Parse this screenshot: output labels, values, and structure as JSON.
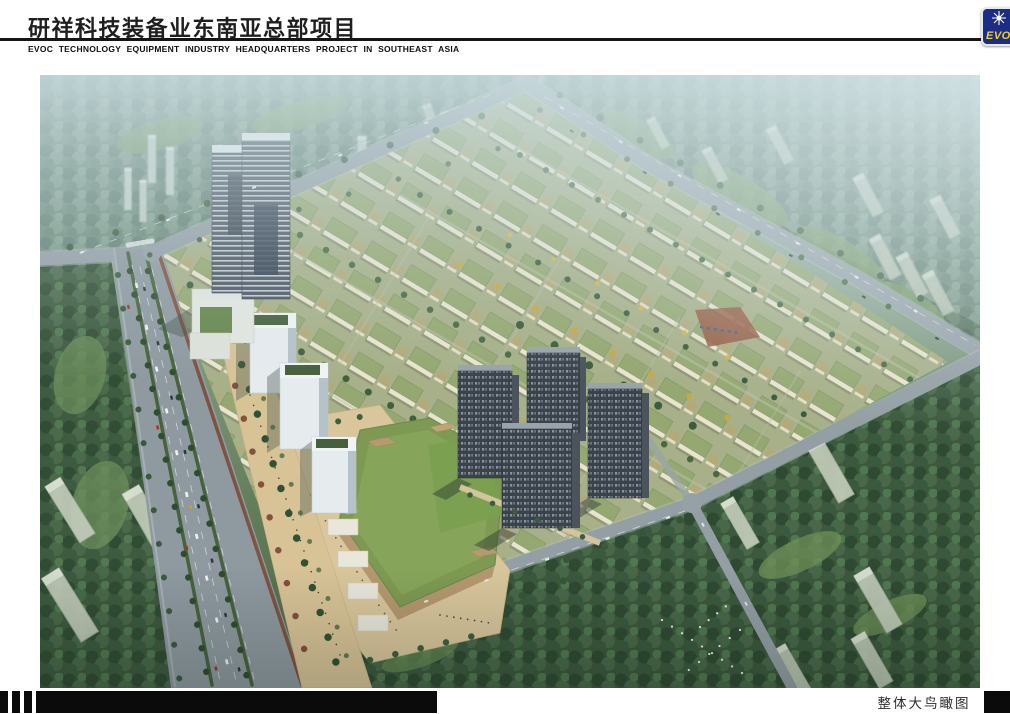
{
  "header": {
    "title": "研祥科技装备业东南亚总部项目",
    "subtitle": "EVOC TECHNOLOGY EQUIPMENT INDUSTRY HEADQUARTERS PROJECT IN SOUTHEAST ASIA",
    "logo": {
      "text": "EVOC",
      "icon": "starburst-icon",
      "bg_color": "#1c2d85",
      "text_color": "#f2cf25"
    }
  },
  "rendering": {
    "kind": "aerial bird's-eye architectural rendering",
    "scene_elements": [
      "twin high-rise office towers at north-west corner of site",
      "rows of small green-roofed industrial campus buildings",
      "four dark residential towers at site center-south",
      "large grass-roofed exhibition hall with beige pedestrian plaza",
      "tree-lined multi-lane boulevard along west edge",
      "diagonal arterial roads bounding the site",
      "hazy surrounding city blocks with apartment slabs and dense trees",
      "flock of white birds near south road"
    ],
    "palette": {
      "haze": "#cbdee2",
      "trees_near": "#3d583c",
      "trees_far": "#6c8878",
      "road": "#939ea5",
      "campus_roof": "#94a871",
      "plaza": "#d9c69c",
      "hall_roof": "#7e9a52",
      "tower_glass": "#4d5763",
      "residential_dark": "#3a424b"
    }
  },
  "footer": {
    "caption": "整体大鸟瞰图"
  }
}
